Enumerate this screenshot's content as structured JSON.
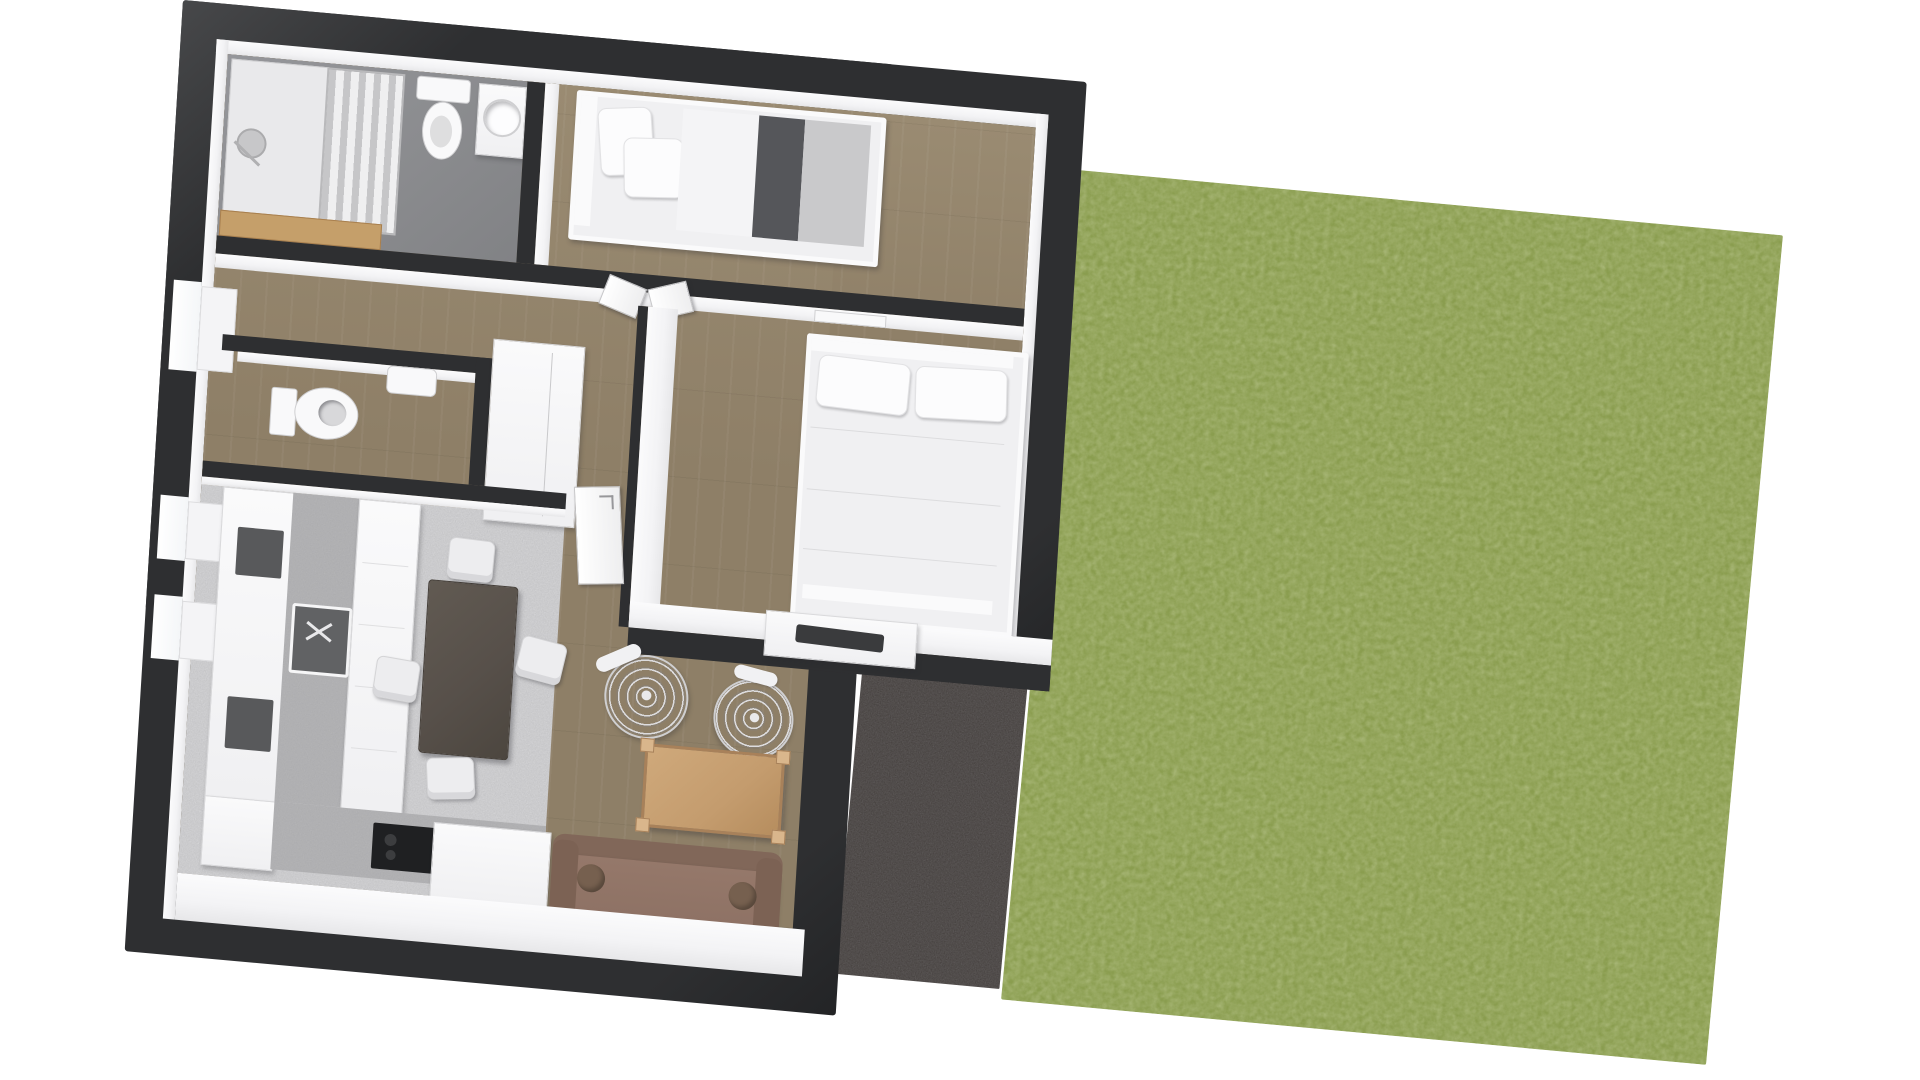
{
  "scene": {
    "type": "3d-floor-plan-top-down-render",
    "description": "Dollhouse-view rendering of an apartment with garden lawn and patio; no text labels are rendered in the image",
    "background": "#ffffff",
    "colors": {
      "background": "#ffffff",
      "wall": "#2e2f31",
      "wallEdge": "#47484a",
      "wallFace": "#f3f3f5",
      "wood": "#8e7f67",
      "woodLight": "#9a8b72",
      "bath": "#8b8c8f",
      "concrete": "#d3d3d5",
      "counter": "#b4b4b6",
      "appliance": "#58595b",
      "sinkBasin": "#616264",
      "cooktop": "#1f2022",
      "grass": "#8a9d4f",
      "patio": "#474240",
      "sofa": "#8d7164",
      "sofaBack": "#816759",
      "sofaArm": "#7c6254",
      "bolster": "#76604f",
      "coffee": "#c49c6e",
      "coffeeEdge": "#a8815a",
      "dining": "#57504a",
      "blanket": "#55565a",
      "mattress": "#c9c9cb",
      "vanity": "#c59f6a",
      "tv": "#3a3b3d",
      "glass1": "#c6c6c8",
      "glass2": "#efeff0"
    },
    "outdoor": {
      "lawn": "large rotated rectangle of textured grass, right side",
      "patio": "dark paved terrace between house and lawn"
    },
    "rooms": [
      {
        "id": "bathroom",
        "floor": "gray tile",
        "items": [
          "shower",
          "shower-glass-screen",
          "toilet",
          "washbasin-cabinet",
          "wood-vanity-shelf"
        ]
      },
      {
        "id": "bedroom-single",
        "floor": "wood",
        "items": [
          "single-bed",
          "pillows",
          "dark-blanket",
          "mattress"
        ]
      },
      {
        "id": "hallway",
        "floor": "wood",
        "items": [
          "double-door",
          "radiator",
          "window"
        ]
      },
      {
        "id": "wc",
        "floor": "wood",
        "items": [
          "toilet",
          "wall-basin"
        ]
      },
      {
        "id": "wardrobe-closet",
        "items": [
          "closet-door"
        ]
      },
      {
        "id": "bedroom-double",
        "floor": "wood",
        "items": [
          "double-bed",
          "two-pillows",
          "sideboard",
          "tv",
          "door"
        ]
      },
      {
        "id": "kitchen-dining",
        "floor": "concrete",
        "items": [
          "kitchen-counter",
          "oven",
          "sink",
          "cooktop",
          "island",
          "dining-table",
          "four-chairs",
          "two-windows"
        ]
      },
      {
        "id": "living-room",
        "floor": "wood",
        "items": [
          "sofa",
          "two-bolster-cushions",
          "coffee-table",
          "two-wicker-chairs"
        ]
      }
    ]
  }
}
